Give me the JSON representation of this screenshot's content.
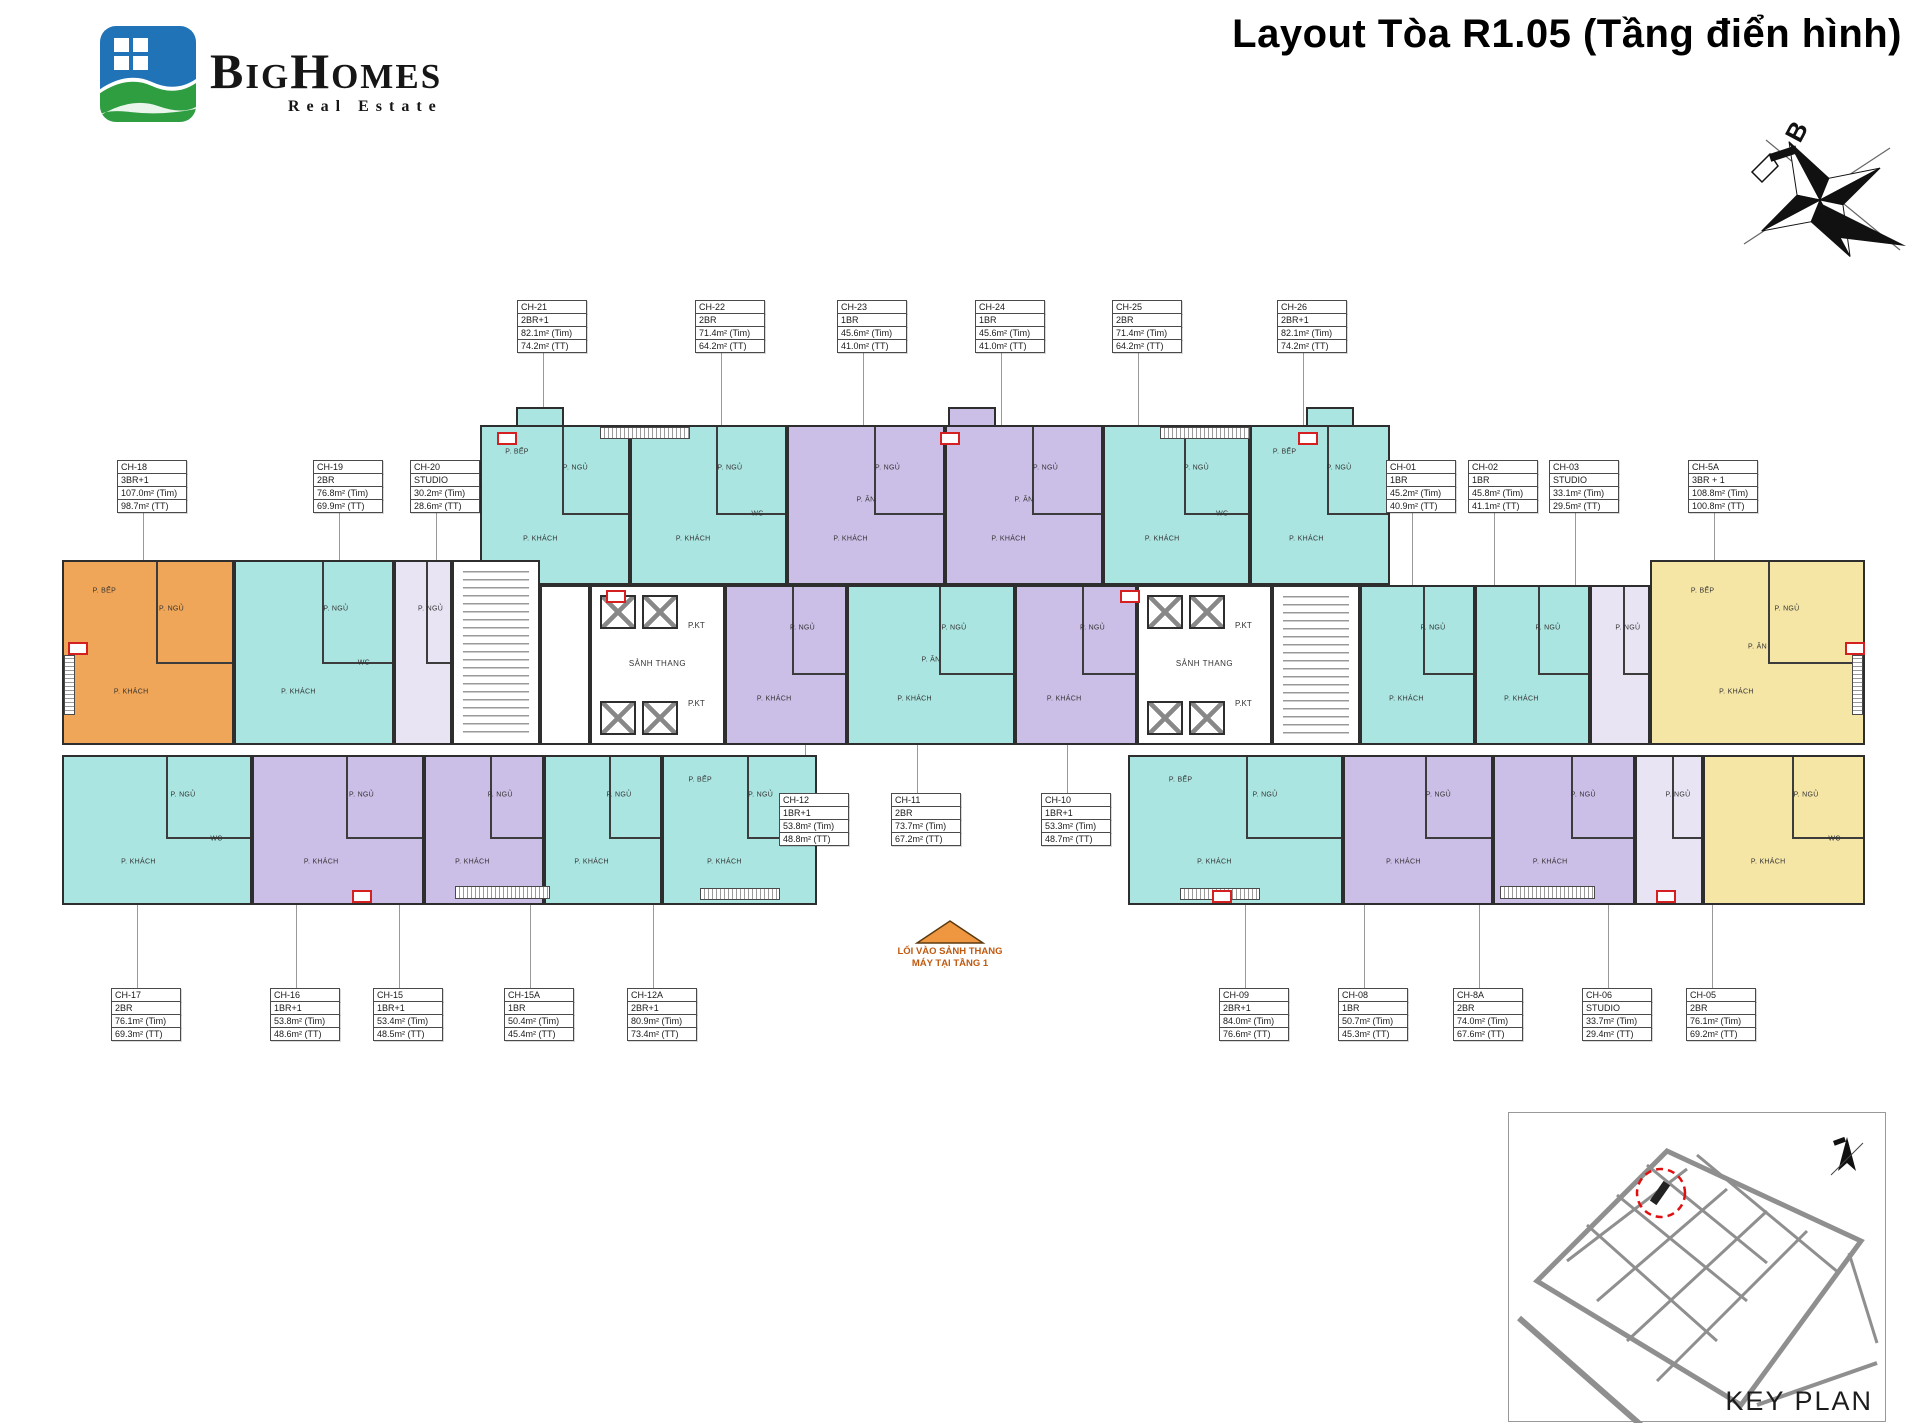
{
  "header": {
    "title": "Layout Tòa R1.05 (Tầng điển hình)",
    "logo": {
      "brand": "BigHomes",
      "tagline": "Real Estate"
    }
  },
  "compass": {
    "north_label": "B"
  },
  "colors": {
    "unit_cyan": "#abe5e1",
    "unit_purple": "#ccbfe7",
    "unit_lavender": "#e9e4f4",
    "unit_orange": "#f0a658",
    "unit_yellow": "#f5e6a6",
    "wall": "#2e2e2e",
    "entrance_orange": "#ef9640",
    "highlight_red": "#d42020"
  },
  "room_labels": {
    "living": "P. KHÁCH",
    "bedroom": "P. NGỦ",
    "kitchen": "P. BẾP",
    "dining": "P. ĂN",
    "wc": "WC",
    "loggia": "LÔ GIA"
  },
  "core_labels": {
    "lobby": "SẢNH THANG",
    "tech": "P.KT"
  },
  "entrance_note": {
    "line1": "LỐI VÀO SẢNH THANG",
    "line2": "MÁY TẠI TẦNG 1"
  },
  "key_plan": {
    "label": "KEY PLAN"
  },
  "units": [
    {
      "id": "CH-21",
      "type": "2BR+1",
      "tim": "82.1m² (Tim)",
      "tt": "74.2m² (TT)",
      "color": "cyan"
    },
    {
      "id": "CH-22",
      "type": "2BR",
      "tim": "71.4m² (Tim)",
      "tt": "64.2m² (TT)",
      "color": "cyan"
    },
    {
      "id": "CH-23",
      "type": "1BR",
      "tim": "45.6m² (Tim)",
      "tt": "41.0m² (TT)",
      "color": "purple"
    },
    {
      "id": "CH-24",
      "type": "1BR",
      "tim": "45.6m² (Tim)",
      "tt": "41.0m² (TT)",
      "color": "purple"
    },
    {
      "id": "CH-25",
      "type": "2BR",
      "tim": "71.4m² (Tim)",
      "tt": "64.2m² (TT)",
      "color": "cyan"
    },
    {
      "id": "CH-26",
      "type": "2BR+1",
      "tim": "82.1m² (Tim)",
      "tt": "74.2m² (TT)",
      "color": "cyan"
    },
    {
      "id": "CH-18",
      "type": "3BR+1",
      "tim": "107.0m² (Tim)",
      "tt": "98.7m² (TT)",
      "color": "orange"
    },
    {
      "id": "CH-19",
      "type": "2BR",
      "tim": "76.8m² (Tim)",
      "tt": "69.9m² (TT)",
      "color": "cyan"
    },
    {
      "id": "CH-20",
      "type": "STUDIO",
      "tim": "30.2m² (Tim)",
      "tt": "28.6m² (TT)",
      "color": "lavender"
    },
    {
      "id": "CH-01",
      "type": "1BR",
      "tim": "45.2m² (Tim)",
      "tt": "40.9m² (TT)",
      "color": "cyan"
    },
    {
      "id": "CH-02",
      "type": "1BR",
      "tim": "45.8m² (Tim)",
      "tt": "41.1m² (TT)",
      "color": "cyan"
    },
    {
      "id": "CH-03",
      "type": "STUDIO",
      "tim": "33.1m² (Tim)",
      "tt": "29.5m² (TT)",
      "color": "lavender"
    },
    {
      "id": "CH-5A",
      "type": "3BR + 1",
      "tim": "108.8m² (Tim)",
      "tt": "100.8m² (TT)",
      "color": "yellow"
    },
    {
      "id": "CH-12",
      "type": "1BR+1",
      "tim": "53.8m² (Tim)",
      "tt": "48.8m² (TT)",
      "color": "purple"
    },
    {
      "id": "CH-11",
      "type": "2BR",
      "tim": "73.7m² (Tim)",
      "tt": "67.2m² (TT)",
      "color": "cyan"
    },
    {
      "id": "CH-10",
      "type": "1BR+1",
      "tim": "53.3m² (Tim)",
      "tt": "48.7m² (TT)",
      "color": "purple"
    },
    {
      "id": "CH-17",
      "type": "2BR",
      "tim": "76.1m² (Tim)",
      "tt": "69.3m² (TT)",
      "color": "cyan"
    },
    {
      "id": "CH-16",
      "type": "1BR+1",
      "tim": "53.8m² (Tim)",
      "tt": "48.6m² (TT)",
      "color": "purple"
    },
    {
      "id": "CH-15",
      "type": "1BR+1",
      "tim": "53.4m² (Tim)",
      "tt": "48.5m² (TT)",
      "color": "purple"
    },
    {
      "id": "CH-15A",
      "type": "1BR",
      "tim": "50.4m² (Tim)",
      "tt": "45.4m² (TT)",
      "color": "cyan"
    },
    {
      "id": "CH-12A",
      "type": "2BR+1",
      "tim": "80.9m² (Tim)",
      "tt": "73.4m² (TT)",
      "color": "cyan"
    },
    {
      "id": "CH-09",
      "type": "2BR+1",
      "tim": "84.0m² (Tim)",
      "tt": "76.6m² (TT)",
      "color": "cyan"
    },
    {
      "id": "CH-08",
      "type": "1BR",
      "tim": "50.7m² (Tim)",
      "tt": "45.3m² (TT)",
      "color": "purple"
    },
    {
      "id": "CH-8A",
      "type": "2BR",
      "tim": "74.0m² (Tim)",
      "tt": "67.6m² (TT)",
      "color": "purple"
    },
    {
      "id": "CH-06",
      "type": "STUDIO",
      "tim": "33.7m² (Tim)",
      "tt": "29.4m² (TT)",
      "color": "lavender"
    },
    {
      "id": "CH-05",
      "type": "2BR",
      "tim": "76.1m² (Tim)",
      "tt": "69.2m² (TT)",
      "color": "yellow"
    }
  ]
}
